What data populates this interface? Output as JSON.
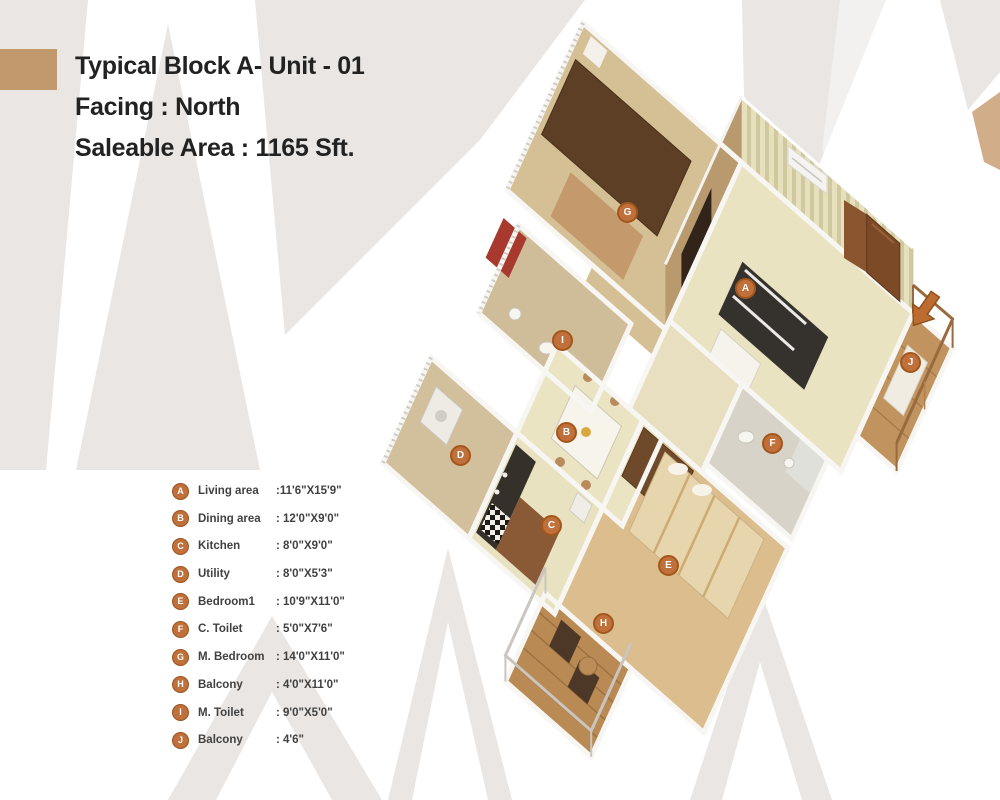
{
  "header": {
    "title": "Typical Block A- Unit - 01",
    "facing": "Facing : North",
    "area": "Saleable Area : 1165 Sft."
  },
  "legend": {
    "items": [
      {
        "letter": "A",
        "name": "Living area",
        "dim": ":11'6\"X15'9\""
      },
      {
        "letter": "B",
        "name": "Dining area",
        "dim": ": 12'0\"X9'0\""
      },
      {
        "letter": "C",
        "name": "Kitchen",
        "dim": ": 8'0\"X9'0\""
      },
      {
        "letter": "D",
        "name": "Utility",
        "dim": ": 8'0\"X5'3\""
      },
      {
        "letter": "E",
        "name": "Bedroom1",
        "dim": ": 10'9\"X11'0\""
      },
      {
        "letter": "F",
        "name": "C. Toilet",
        "dim": ": 5'0\"X7'6\""
      },
      {
        "letter": "G",
        "name": "M. Bedroom",
        "dim": ": 14'0\"X11'0\""
      },
      {
        "letter": "H",
        "name": "Balcony",
        "dim": ": 4'0\"X11'0\""
      },
      {
        "letter": "I",
        "name": "M. Toilet",
        "dim": ": 9'0\"X5'0\""
      },
      {
        "letter": "J",
        "name": "Balcony",
        "dim": ": 4'6\""
      }
    ]
  },
  "plan": {
    "labels": [
      {
        "letter": "A"
      },
      {
        "letter": "B"
      },
      {
        "letter": "C"
      },
      {
        "letter": "D"
      },
      {
        "letter": "E"
      },
      {
        "letter": "F"
      },
      {
        "letter": "G"
      },
      {
        "letter": "H"
      },
      {
        "letter": "I"
      },
      {
        "letter": "J"
      }
    ]
  },
  "colors": {
    "accent": "#c0703a",
    "swatch": "#c2996c",
    "watermark": "#e9e6e3",
    "floor_cream": "#eae3c2",
    "floor_wood": "#dcbd8d",
    "wall_stripe": "#d0c89e"
  }
}
